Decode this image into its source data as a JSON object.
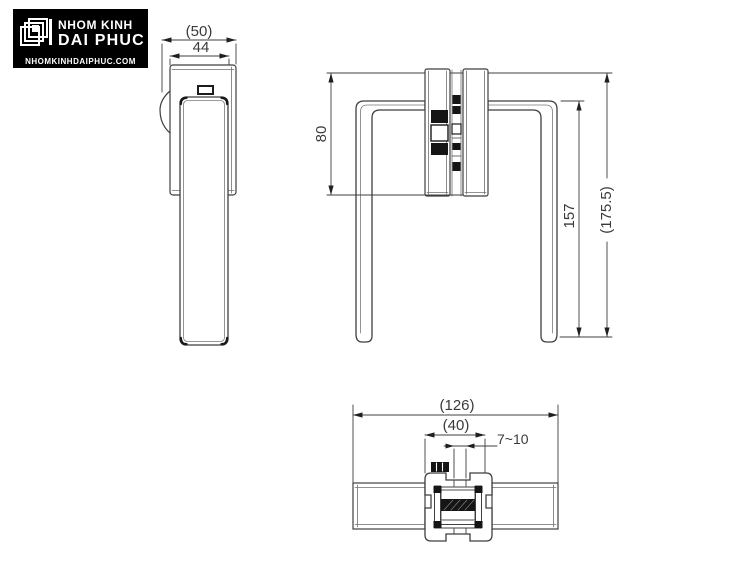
{
  "logo": {
    "brand_line1": "NHOM KINH",
    "brand_line2": "DAI PHUC",
    "website": "NHOMKINHDAIPHUC.COM"
  },
  "drawing": {
    "side_view": {
      "width_overall": "(50)",
      "width_plate": "44"
    },
    "front_view": {
      "plate_height": "80",
      "handle_height": "157",
      "overall_height": "(175.5)"
    },
    "top_view": {
      "length_overall": "(126)",
      "clamp_width": "(40)",
      "glass_thickness_range": "7~10"
    }
  },
  "colors": {
    "line": "#3f3f3f",
    "black_fill": "#151515",
    "background": "#ffffff",
    "logo_background": "#000000",
    "logo_text": "#ffffff"
  }
}
